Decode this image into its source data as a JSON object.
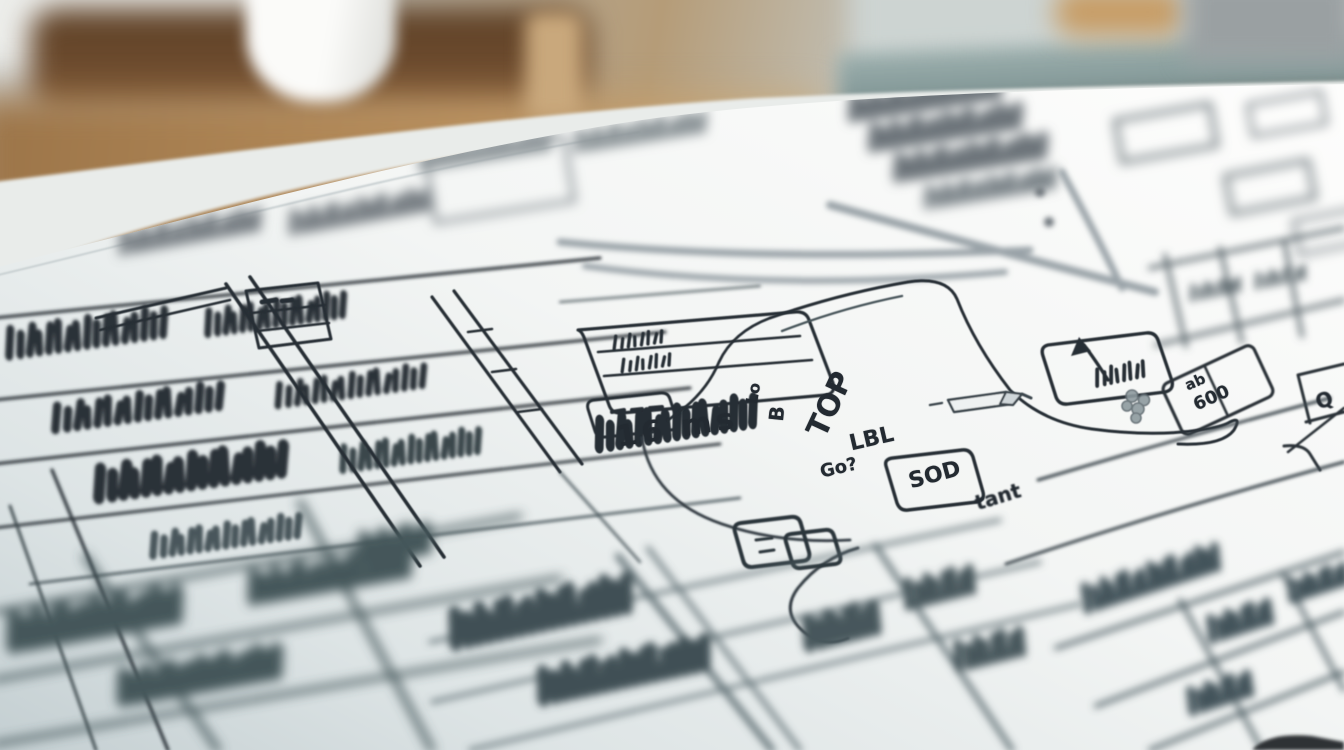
{
  "scene_title": "hand-drawn wireframe sketch on paper",
  "annotations": {
    "top": "TOP",
    "lo": "Lo",
    "b": "B",
    "ms": "16 ms",
    "lbl": "LBL",
    "go": "Go?",
    "sod": "SOD",
    "tant": "tant",
    "ab": "ab",
    "amount": "600",
    "q": "Q"
  },
  "doodles": {
    "arrow": "arrow-up-left-icon",
    "pen": "marker-pen-doodle",
    "toggles": "toggle-squares-doodle",
    "cluster": "grape-cluster-doodle",
    "curl": "swoosh-curl-doodle"
  },
  "palette": {
    "ink": "#262d34",
    "ink_soft": "#4a565c",
    "ink_faint": "#8d979c",
    "paper": "#f4f5f3",
    "paper_shadow": "#c6d1d4",
    "desk_wood": "#b98f5c",
    "desk_wood_dark": "#5d4026",
    "wall_teal": "#5e7678",
    "wall_gray": "#cdd4d2",
    "mug": "#fbfbf9"
  }
}
